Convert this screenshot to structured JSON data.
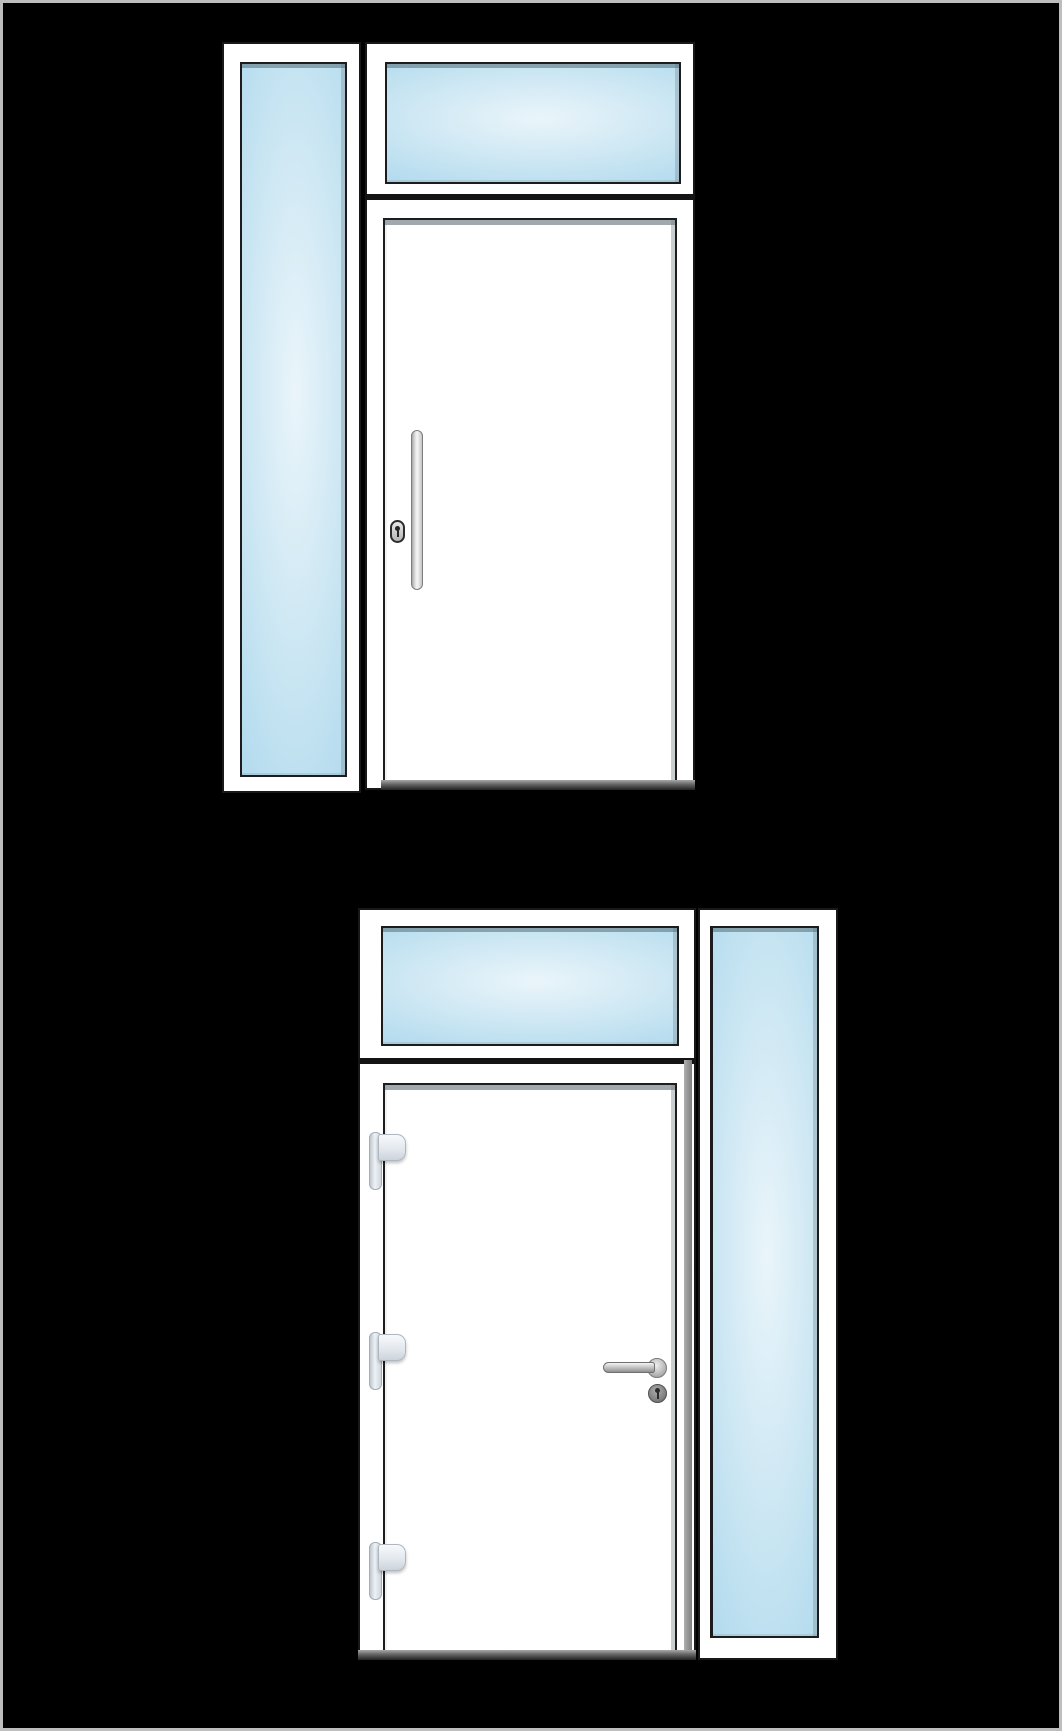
{
  "colors": {
    "background": "#000000",
    "canvas-border": "#bdbdbd",
    "frame-white": "#ffffff",
    "outline-dark": "#181818",
    "glass-center": "#eaf5fa",
    "glass-mid": "#cfe8f4",
    "glass-edge": "#b5dcee",
    "divider-dark": "#141414",
    "threshold-top": "#a8a8a8",
    "threshold-bottom": "#222222",
    "metal-light": "#f4f4f4",
    "metal-dark": "#8f8f8f",
    "hinge-light": "#eef2f6",
    "hinge-border": "#a4adb6",
    "joint-shadow": "#9a9a9a"
  },
  "assemblies": [
    {
      "id": "top",
      "type": "entry-door-with-transom-and-sidelight",
      "sidelight_position": "left",
      "panels": [
        "sidelight-glass",
        "transom-glass",
        "door-leaf"
      ],
      "door": {
        "handle": "vertical-pull-bar",
        "lock": "oval-cylinder",
        "hinges_visible": 0
      }
    },
    {
      "id": "bottom",
      "type": "entry-door-with-transom-and-sidelight",
      "sidelight_position": "right",
      "panels": [
        "transom-glass",
        "door-leaf",
        "sidelight-glass"
      ],
      "door": {
        "handle": "lever-handle",
        "lock": "round-cylinder",
        "hinges_visible": 3
      }
    }
  ]
}
